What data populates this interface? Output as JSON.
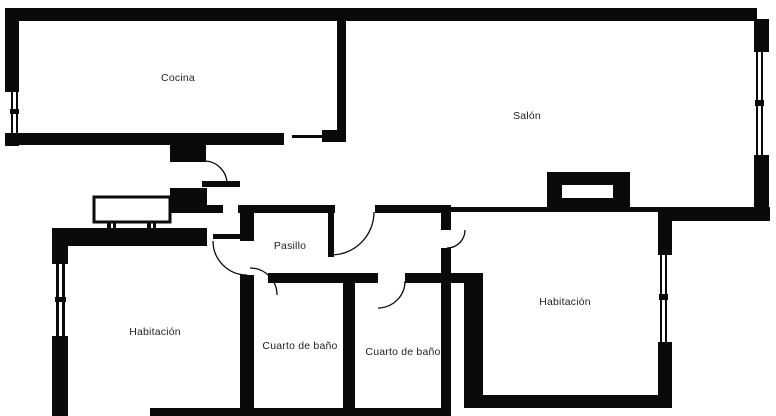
{
  "plan_title": "Apartment floor plan",
  "colors": {
    "wall": "#0a0a0a",
    "background": "#ffffff",
    "label": "#1f1f1f"
  },
  "rooms": [
    {
      "id": "cocina",
      "label": "Cocina"
    },
    {
      "id": "salon",
      "label": "Salón"
    },
    {
      "id": "pasillo",
      "label": "Pasillo"
    },
    {
      "id": "habitacion-1",
      "label": "Habitación"
    },
    {
      "id": "cuarto-de-bano-1",
      "label": "Cuarto de baño"
    },
    {
      "id": "cuarto-de-bano-2",
      "label": "Cuarto de baño"
    },
    {
      "id": "habitacion-2",
      "label": "Habitación"
    }
  ]
}
